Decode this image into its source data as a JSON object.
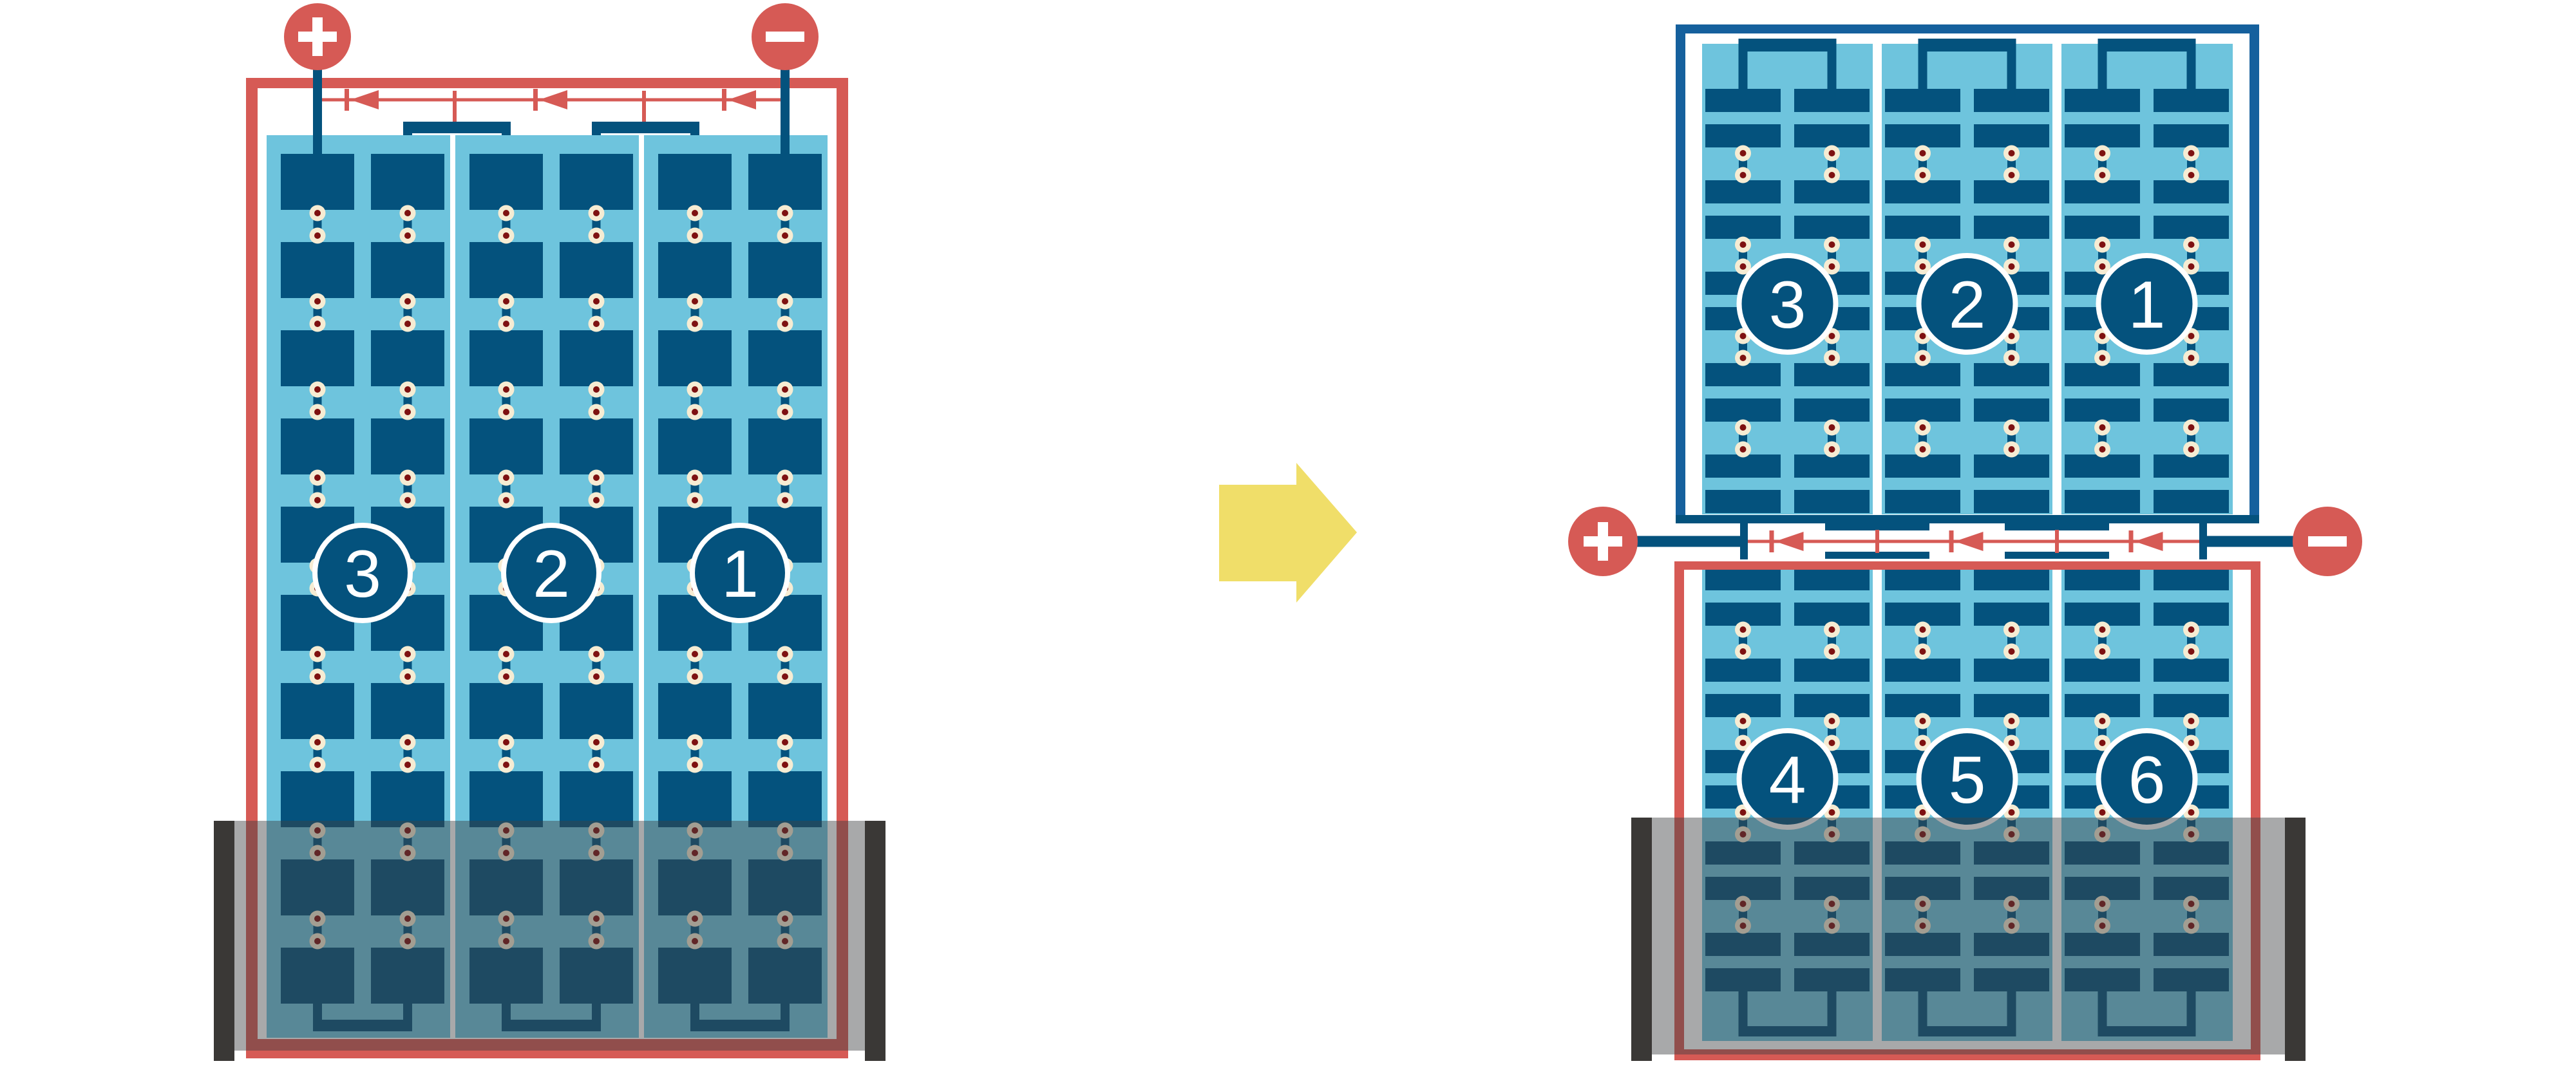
{
  "diagram_type": "solar-panel-bypass-diode-wiring-comparison",
  "colors": {
    "page_bg": "#ffffff",
    "panel_bg": "#6EC4DD",
    "cell_blue": "#04527D",
    "wire_red": "#D65A55",
    "frame_blue": "#15609D",
    "pad_ring": "#F6ECD3",
    "pad_dot": "#7E1111",
    "divider_white": "#ffffff",
    "shade_band": "rgba(62,64,66,0.45)",
    "shade_edge_bar": "#3A3836",
    "arrow_yellow": "#F0DE69",
    "badge_fill": "#04527D",
    "badge_stroke": "#ffffff",
    "badge_text": "#ffffff",
    "terminal_glyph": "#ffffff"
  },
  "arrow": {
    "icon": "transform-arrow-right-icon",
    "direction": "right"
  },
  "left_assembly": {
    "terminals": [
      {
        "polarity": "positive",
        "label": "+",
        "icon": "plus-icon"
      },
      {
        "polarity": "negative",
        "label": "−",
        "icon": "minus-icon"
      }
    ],
    "strings": [
      {
        "label": "3"
      },
      {
        "label": "2"
      },
      {
        "label": "1"
      }
    ],
    "bypass_diode_count": 3,
    "rows_of_cells": 10,
    "columns_per_string": 2,
    "pad_rows": 9,
    "partial_shading": "bottom"
  },
  "right_assembly": {
    "terminals": [
      {
        "polarity": "positive",
        "label": "+",
        "icon": "plus-icon"
      },
      {
        "polarity": "negative",
        "label": "−",
        "icon": "minus-icon"
      }
    ],
    "top_panel": {
      "strings": [
        {
          "label": "3"
        },
        {
          "label": "2"
        },
        {
          "label": "1"
        }
      ],
      "half_cell_pairs": 5,
      "columns_per_string": 2,
      "pad_rows": 4
    },
    "bottom_panel": {
      "strings": [
        {
          "label": "4"
        },
        {
          "label": "5"
        },
        {
          "label": "6"
        }
      ],
      "half_cell_pairs": 5,
      "columns_per_string": 2,
      "pad_rows": 4
    },
    "bypass_diode_count": 3,
    "partial_shading": "bottom"
  }
}
